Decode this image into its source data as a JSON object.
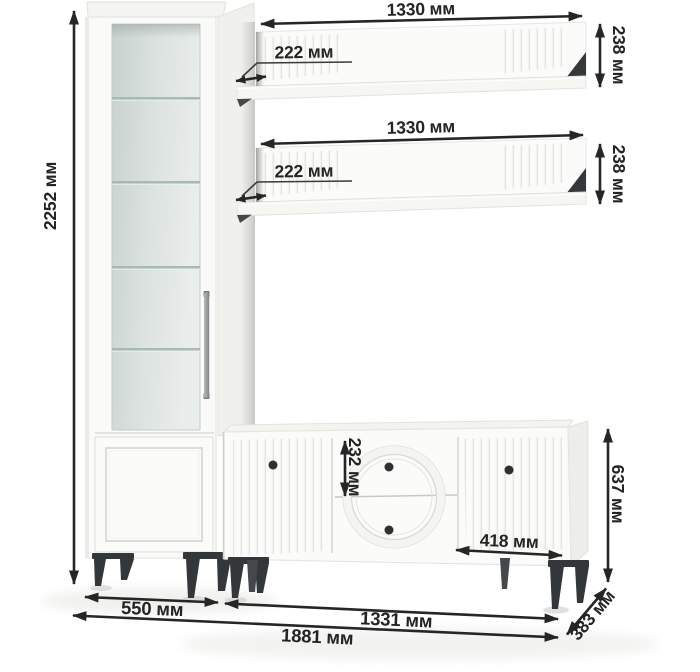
{
  "diagram": {
    "type": "furniture-dimension-diagram",
    "subject": "white living room wall unit: display cabinet, two wall shelves, tv stand",
    "unit": "мм",
    "colors": {
      "background": "#ffffff",
      "furniture_white": "#fbfbf9",
      "glass_interior": "#d2dbd7",
      "legs_and_knobs": "#34373a",
      "dimension_ink": "#262626"
    },
    "dimensions": {
      "total_height": "2252 мм",
      "shelf_top_width": "1330 мм",
      "shelf_top_height": "238 мм",
      "shelf_top_depth": "222 мм",
      "shelf_bottom_width": "1330 мм",
      "shelf_bottom_height": "238 мм",
      "shelf_bottom_depth": "222 мм",
      "drawer_height": "232 мм",
      "stand_door_width": "418 мм",
      "stand_height": "637 мм",
      "cabinet_width": "550 мм",
      "stand_width": "1331 мм",
      "total_width": "1881 мм",
      "stand_depth": "383 мм"
    }
  }
}
